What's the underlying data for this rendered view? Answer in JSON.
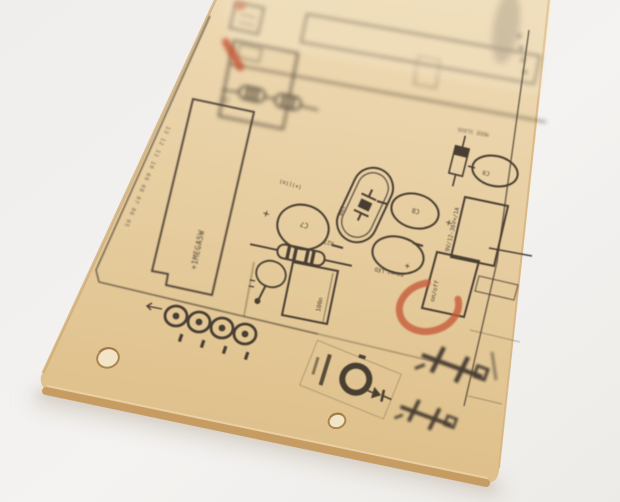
{
  "scene": {
    "type": "photograph",
    "subject": "Bare printed circuit board silkscreen lying on a white surface, photographed at an angle with shallow depth of field",
    "background_color": "#f1efed",
    "board_color": "#e5c795",
    "board_edge_color": "#c69b60",
    "silkscreen_color": "#3d3326",
    "red_marker_color": "#c24f2e",
    "hole_color": "#f1e3c4"
  },
  "labels": {
    "c7": "C7",
    "r27": "R27",
    "c8": "C8",
    "c9": "C9",
    "bq1": "BQ1",
    "c100n": "100n",
    "power_led": "power LED",
    "on_off": "on/off",
    "supply": "9V/12-36V=/1A",
    "big_res": "+1MEGA5W",
    "edge_scale": "13 12 11 10 09 08 07 06 05",
    "top_label": "MODE SLAVA",
    "polarity": "(+)|(o)",
    "plus": "+"
  }
}
